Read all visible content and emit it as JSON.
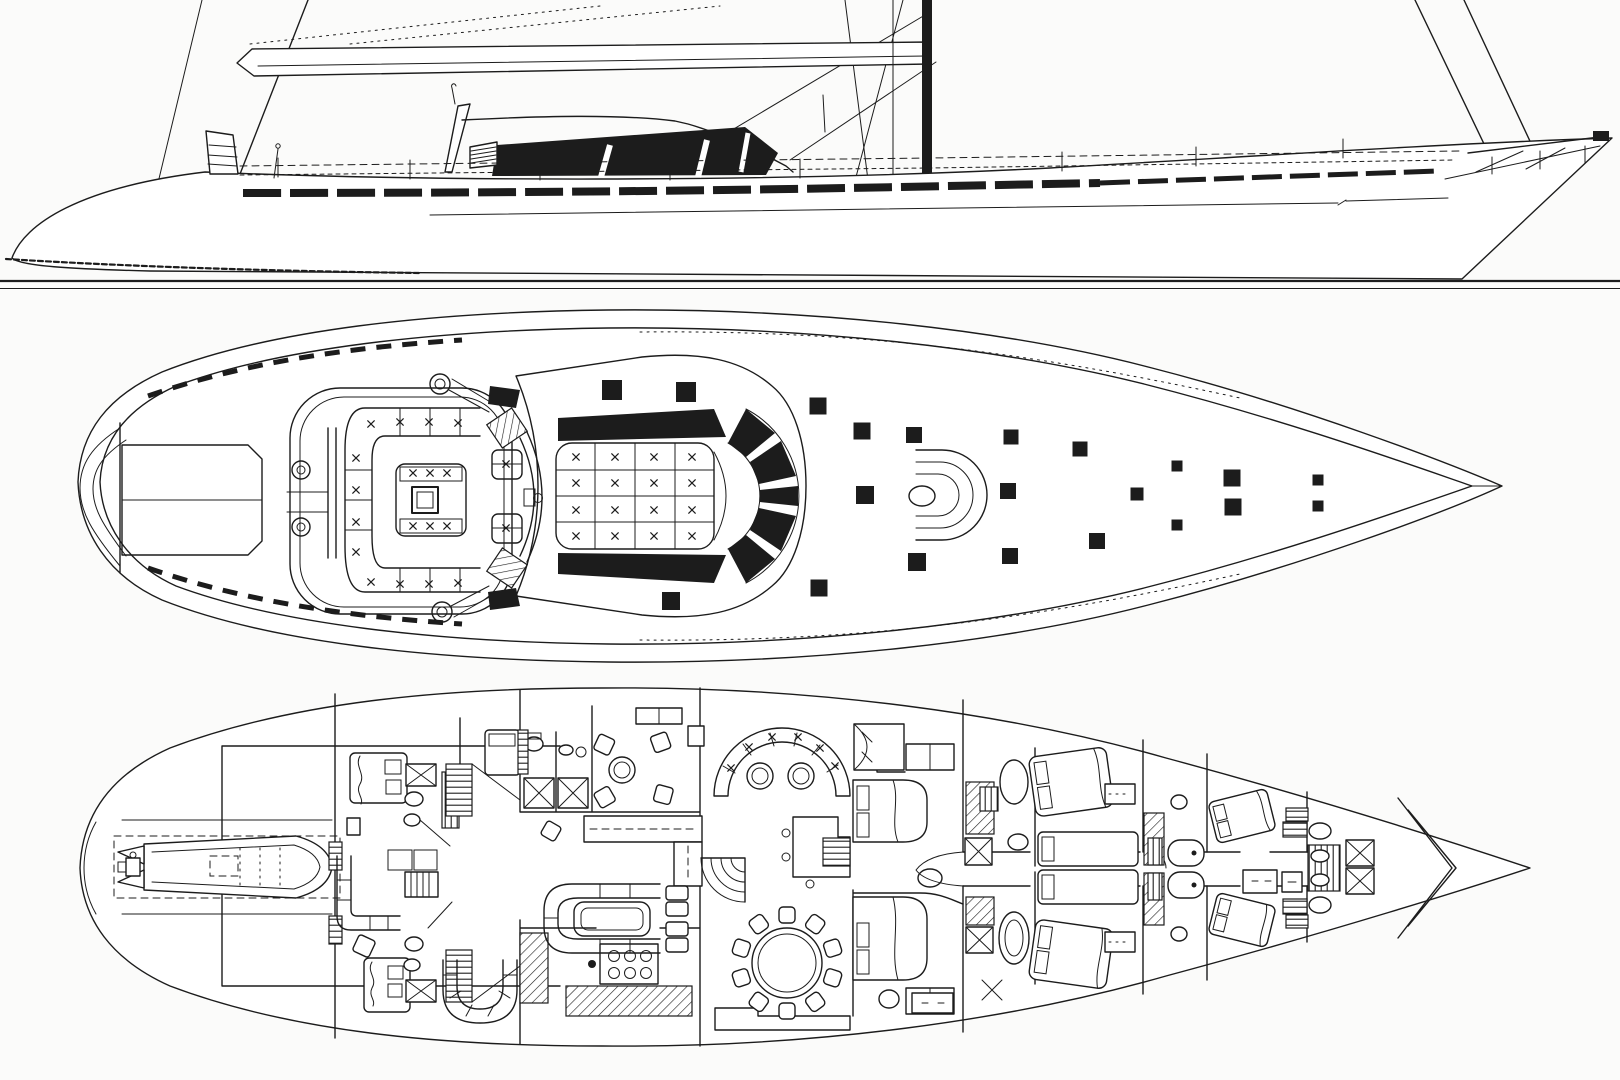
{
  "figure": {
    "type": "scanned monochrome line drawing",
    "subject": "Sailing superyacht general arrangement",
    "ink_color": "#1c1c1c",
    "paper_color": "#fbfbfa",
    "views": [
      {
        "id": "profile",
        "label": "Outboard profile with rig"
      },
      {
        "id": "deck-plan",
        "label": "Deck plan"
      },
      {
        "id": "accommodation",
        "label": "Accommodation / interior plan"
      }
    ]
  },
  "profile": {
    "stanchions": [
      [
        278,
        177
      ],
      [
        410,
        179
      ],
      [
        540,
        180
      ],
      [
        670,
        180
      ],
      [
        800,
        178
      ],
      [
        1062,
        171
      ],
      [
        1196,
        166
      ],
      [
        1343,
        158
      ]
    ]
  },
  "deck_plan": {
    "hatches": [
      [
        612,
        390,
        20
      ],
      [
        686,
        392,
        20
      ],
      [
        818,
        406,
        17
      ],
      [
        862,
        431,
        17
      ],
      [
        914,
        435,
        16
      ],
      [
        1011,
        437,
        15
      ],
      [
        1080,
        449,
        15
      ],
      [
        1177,
        466,
        11
      ],
      [
        1232,
        478,
        17
      ],
      [
        1318,
        480,
        11
      ],
      [
        865,
        495,
        18
      ],
      [
        1008,
        491,
        16
      ],
      [
        1137,
        494,
        13
      ],
      [
        1318,
        506,
        11
      ],
      [
        671,
        601,
        18
      ],
      [
        819,
        588,
        17
      ],
      [
        917,
        562,
        18
      ],
      [
        1010,
        556,
        16
      ],
      [
        1097,
        541,
        16
      ],
      [
        1177,
        525,
        11
      ],
      [
        1233,
        507,
        17
      ]
    ],
    "cockpit_marks": [
      [
        371,
        424
      ],
      [
        400,
        422
      ],
      [
        429,
        422
      ],
      [
        458,
        423
      ],
      [
        356,
        458
      ],
      [
        356,
        490
      ],
      [
        356,
        522
      ],
      [
        356,
        552
      ],
      [
        371,
        582
      ],
      [
        400,
        584
      ],
      [
        429,
        584
      ],
      [
        458,
        583
      ],
      [
        506,
        464
      ],
      [
        506,
        528
      ],
      [
        413,
        473
      ],
      [
        430,
        473
      ],
      [
        447,
        473
      ],
      [
        413,
        526
      ],
      [
        430,
        526
      ],
      [
        447,
        526
      ]
    ],
    "sunpad_marks": [
      [
        576,
        457
      ],
      [
        615,
        457
      ],
      [
        654,
        457
      ],
      [
        692,
        457
      ],
      [
        576,
        483
      ],
      [
        615,
        483
      ],
      [
        654,
        483
      ],
      [
        692,
        483
      ],
      [
        576,
        510
      ],
      [
        615,
        510
      ],
      [
        654,
        510
      ],
      [
        692,
        510
      ],
      [
        576,
        536
      ],
      [
        615,
        536
      ],
      [
        654,
        536
      ],
      [
        692,
        536
      ]
    ]
  },
  "accommodation": {
    "dining_table": {
      "cx": 787,
      "cy": 963,
      "radius": 35,
      "inner_radius": 29,
      "chair_count": 10,
      "chair_radius": 48,
      "chair_size": 16
    },
    "sofa_marks": [
      [
        731,
        768
      ],
      [
        749,
        747
      ],
      [
        772,
        737
      ],
      [
        798,
        737
      ],
      [
        820,
        748
      ],
      [
        835,
        766
      ]
    ],
    "stove_burners": [
      [
        614,
        956
      ],
      [
        630,
        956
      ],
      [
        646,
        956
      ],
      [
        614,
        973
      ],
      [
        630,
        973
      ],
      [
        646,
        973
      ]
    ]
  }
}
